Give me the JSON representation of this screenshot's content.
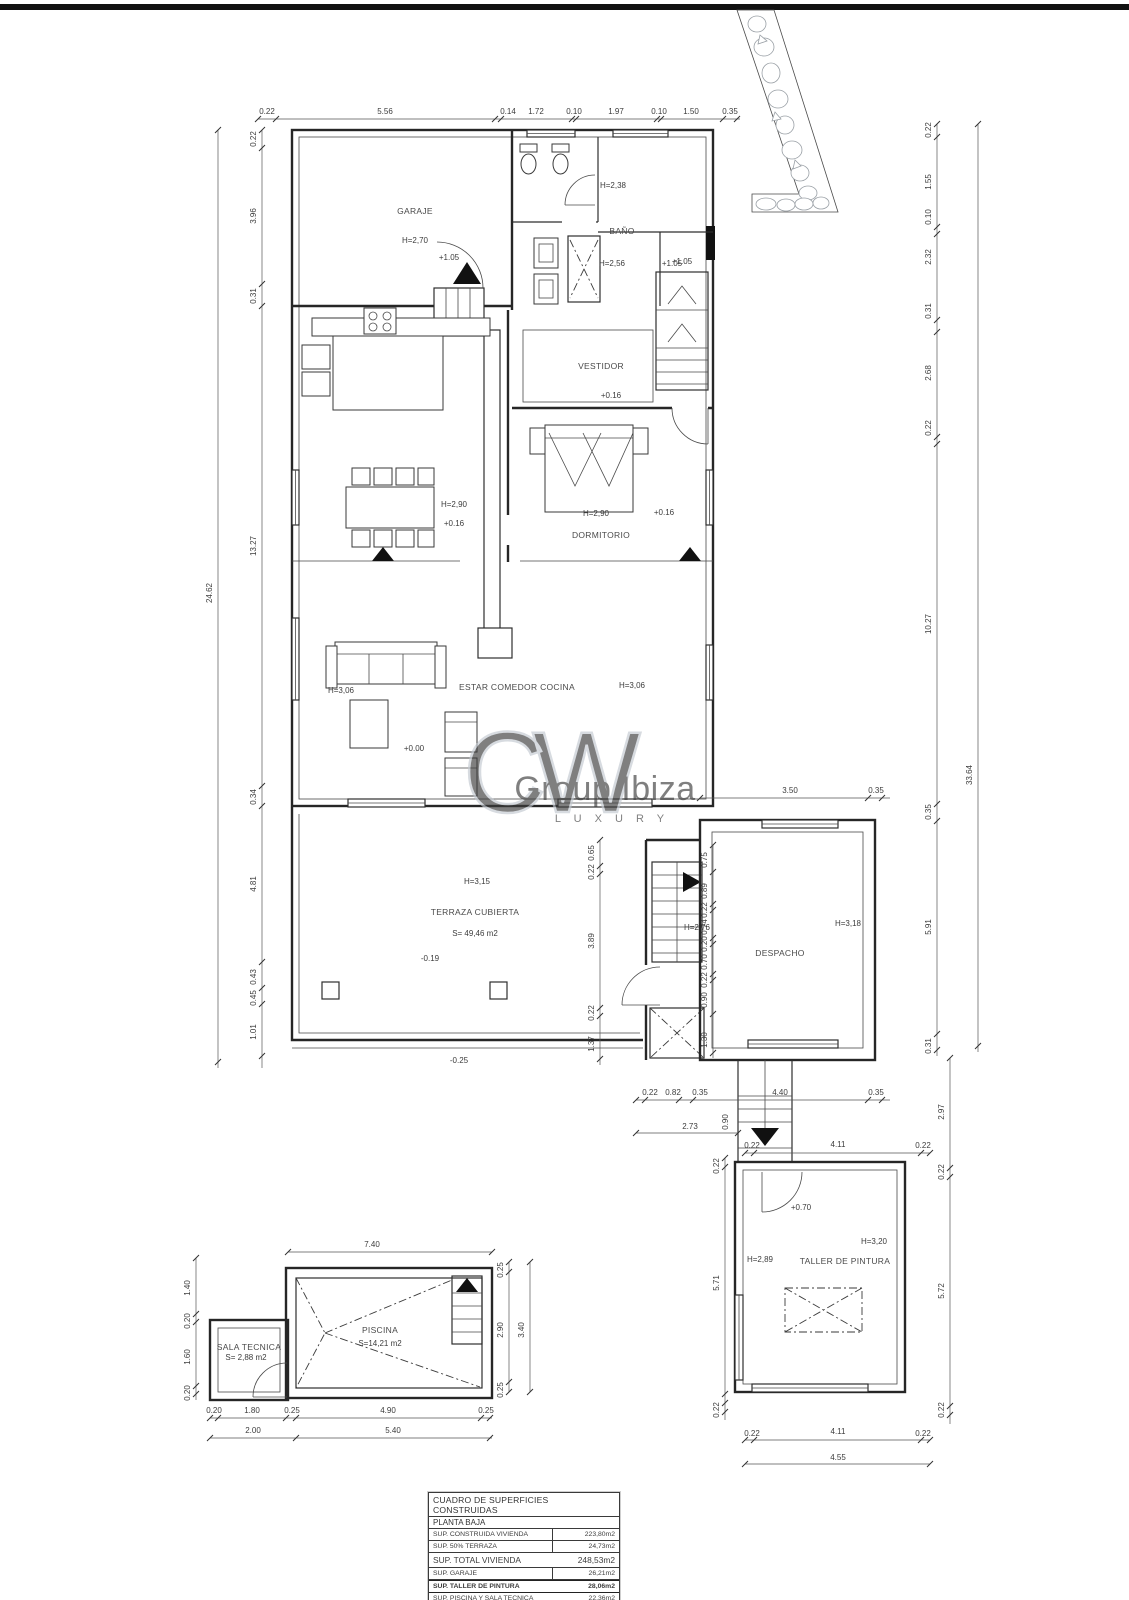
{
  "watermark": {
    "logo": "CW",
    "brand": "Group Ibiza",
    "tagline": "L U X U R Y"
  },
  "rooms": {
    "garaje": {
      "name": "GARAJE",
      "height": "H=2,70",
      "door_level": "+1.05"
    },
    "aseo": {
      "height": "H=2,38"
    },
    "bano": {
      "name": "BAÑO",
      "height": "H=2,56",
      "level": "+1.05"
    },
    "escalera_sup": {
      "level": "+1.05"
    },
    "vestidor": {
      "name": "VESTIDOR",
      "level": "+0.16"
    },
    "comedor": {
      "height": "H=2,90",
      "level": "+0.16"
    },
    "dormitorio": {
      "name": "DORMITORIO",
      "height": "H=2,90",
      "level": "+0.16"
    },
    "estar": {
      "name": "ESTAR COMEDOR COCINA",
      "height_left": "H=3,06",
      "height_right": "H=3,06",
      "level": "+0.00"
    },
    "terraza": {
      "name": "TERRAZA CUBIERTA",
      "height": "H=3,15",
      "area": "S= 49,46 m2",
      "level": "-0.19",
      "step_level": "-0.25"
    },
    "escalera": {
      "height": "H=2,76"
    },
    "despacho": {
      "name": "DESPACHO",
      "height": "H=3,18"
    },
    "taller": {
      "name": "TALLER DE PINTURA",
      "height": "H=3,20",
      "height_left": "H=2,89",
      "level": "+0.70"
    },
    "piscina": {
      "name": "PISCINA",
      "area": "S=14,21 m2"
    },
    "sala_tecnica": {
      "name": "SALA TECNICA",
      "area": "S= 2,88 m2"
    }
  },
  "dims": {
    "top": [
      "0.22",
      "5.56",
      "0.14",
      "1.72",
      "0.10",
      "1.97",
      "0.10",
      "1.50",
      "0.35"
    ],
    "left": [
      "0.22",
      "3.96",
      "0.31",
      "13.27",
      "0.34",
      "4.81",
      "0.43",
      "0.45",
      "1.01"
    ],
    "left_total": "24.62",
    "right": [
      "0.22",
      "1.55",
      "0.10",
      "2.32",
      "0.31",
      "2.68",
      "0.22",
      "10.27",
      "0.35",
      "5.91",
      "0.31"
    ],
    "right_total": "33.64",
    "right_lower": [
      "2.97",
      "0.22",
      "5.72",
      "0.22"
    ],
    "terraza_inner": [
      "0.65",
      "0.22",
      "3.89",
      "0.22",
      "1.37"
    ],
    "stairhall": [
      "0.75",
      "0.89",
      "0.22",
      "0.74",
      "0.20",
      "0.70",
      "0.22",
      "0.90",
      "1.30"
    ],
    "despacho_top": [
      "3.50",
      "0.35"
    ],
    "stairs_mid": [
      "0.22",
      "0.82",
      "0.35",
      "4.40",
      "0.35",
      "2.73",
      "0.90"
    ],
    "taller_top": [
      "0.22",
      "4.11",
      "0.22"
    ],
    "taller_bottom": [
      "0.22",
      "4.11",
      "0.22"
    ],
    "taller_bottom_total": "4.55",
    "taller_left": [
      "0.22",
      "5.71",
      "0.22"
    ],
    "pool_top_total": "7.40",
    "pool_left": [
      "1.40",
      "0.20",
      "1.60",
      "0.20"
    ],
    "pool_bottom": [
      "0.20",
      "1.80",
      "0.25",
      "4.90",
      "0.25"
    ],
    "pool_bottom2": [
      "2.00",
      "5.40"
    ],
    "pool_right": [
      "0.25",
      "2.90",
      "0.25"
    ],
    "pool_right_total": "3.40"
  },
  "table": {
    "title": "CUADRO DE SUPERFICIES CONSTRUIDAS",
    "floor": "PLANTA BAJA",
    "rows": [
      {
        "label": "SUP. CONSTRUIDA VIVIENDA",
        "value": "223,80m2"
      },
      {
        "label": "SUP. 50% TERRAZA",
        "value": "24,73m2"
      },
      {
        "label": "SUP. TOTAL VIVIENDA",
        "value": "248,53m2"
      },
      {
        "label": "SUP. GARAJE",
        "value": "26,21m2"
      },
      {
        "label": "SUP. TALLER DE PINTURA",
        "value": "28,06m2"
      },
      {
        "label": "SUP. PISCINA Y SALA TECNICA",
        "value": "22,36m2"
      }
    ]
  }
}
